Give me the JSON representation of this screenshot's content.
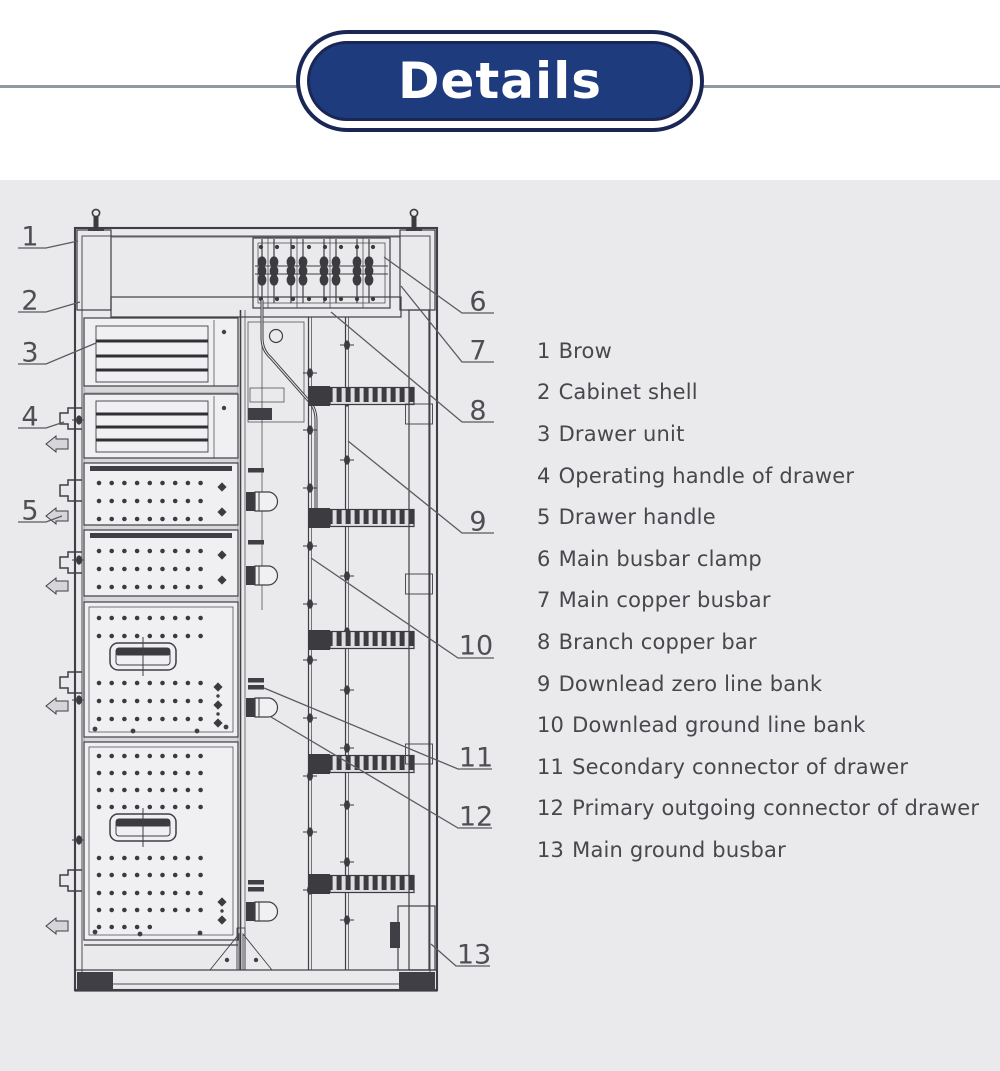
{
  "header": {
    "title": "Details"
  },
  "legend": {
    "items": [
      {
        "num": "1",
        "label": "Brow"
      },
      {
        "num": "2",
        "label": "Cabinet shell"
      },
      {
        "num": "3",
        "label": "Drawer unit"
      },
      {
        "num": "4",
        "label": "Operating handle of drawer"
      },
      {
        "num": "5",
        "label": "Drawer handle"
      },
      {
        "num": "6",
        "label": "Main busbar clamp"
      },
      {
        "num": "7",
        "label": "Main copper busbar"
      },
      {
        "num": "8",
        "label": "Branch copper bar"
      },
      {
        "num": "9",
        "label": "Downlead zero line bank"
      },
      {
        "num": "10",
        "label": "Downlead ground line bank"
      },
      {
        "num": "11",
        "label": "Secondary connector of drawer"
      },
      {
        "num": "12",
        "label": "Primary outgoing connector of drawer"
      },
      {
        "num": "13",
        "label": "Main ground busbar"
      }
    ]
  },
  "colors": {
    "banner_fill": "#1e3c7d",
    "banner_border": "#1a2656",
    "banner_text": "#ffffff",
    "panel_bg": "#eae9eb",
    "divider_line": "#9298a1",
    "drawing_line": "#3f3f45",
    "legend_text": "#47474c"
  }
}
